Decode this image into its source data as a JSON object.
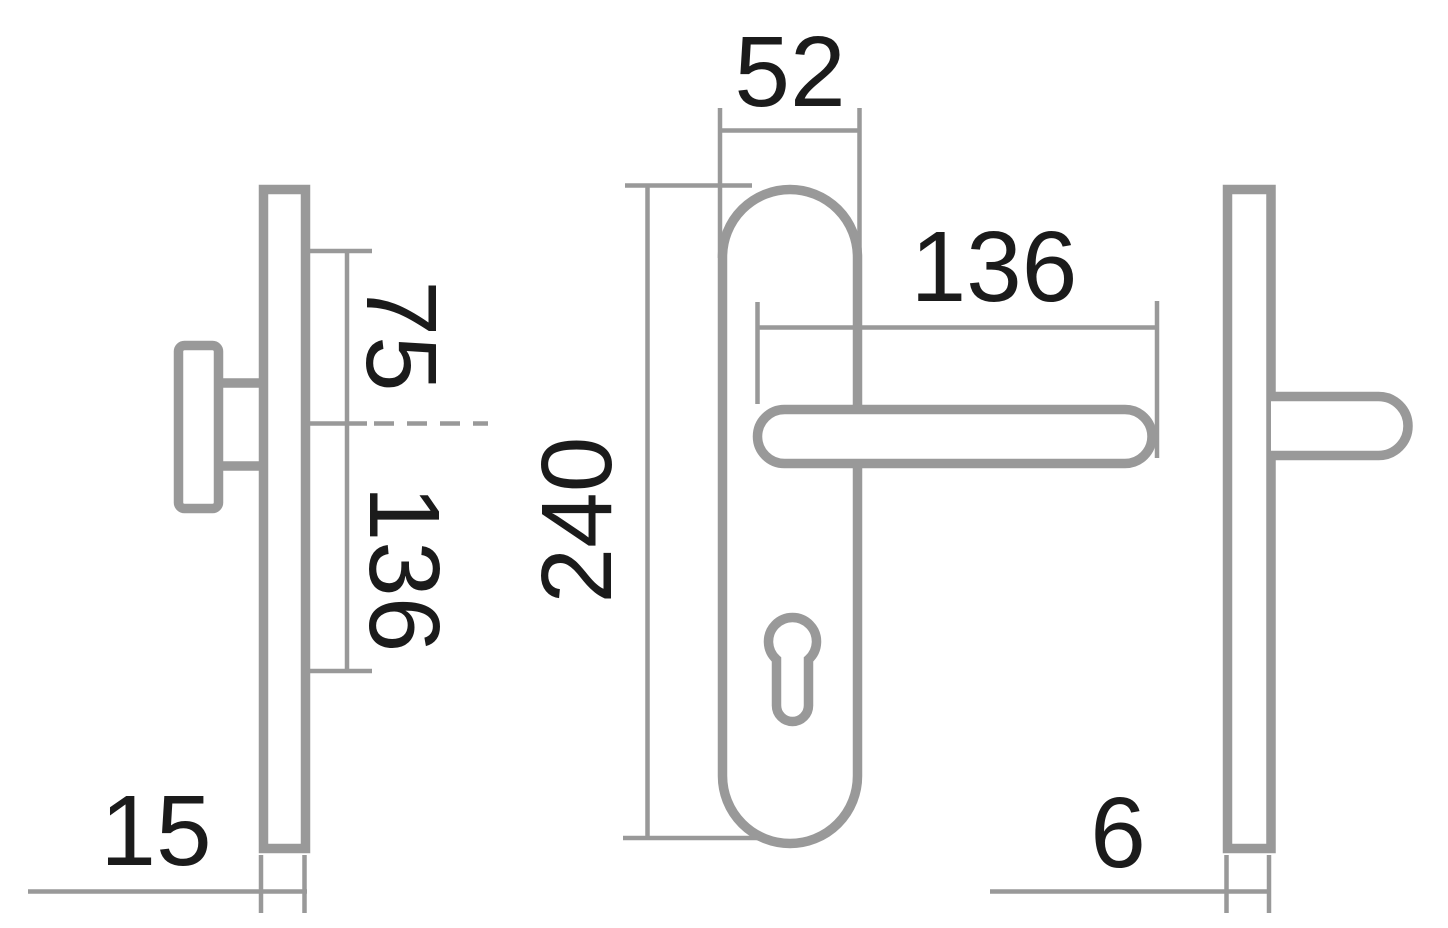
{
  "drawing": {
    "background_color": "#ffffff",
    "outline_color": "#999999",
    "dimension_line_color": "#999999",
    "label_color": "#1b1b1b",
    "dimensions": {
      "front_plate_width": "52",
      "front_handle_length": "136",
      "front_plate_height": "240",
      "side_upper_offset": "75",
      "side_lower_offset": "136",
      "inner_plate_thickness": "15",
      "outer_plate_thickness": "6"
    }
  }
}
